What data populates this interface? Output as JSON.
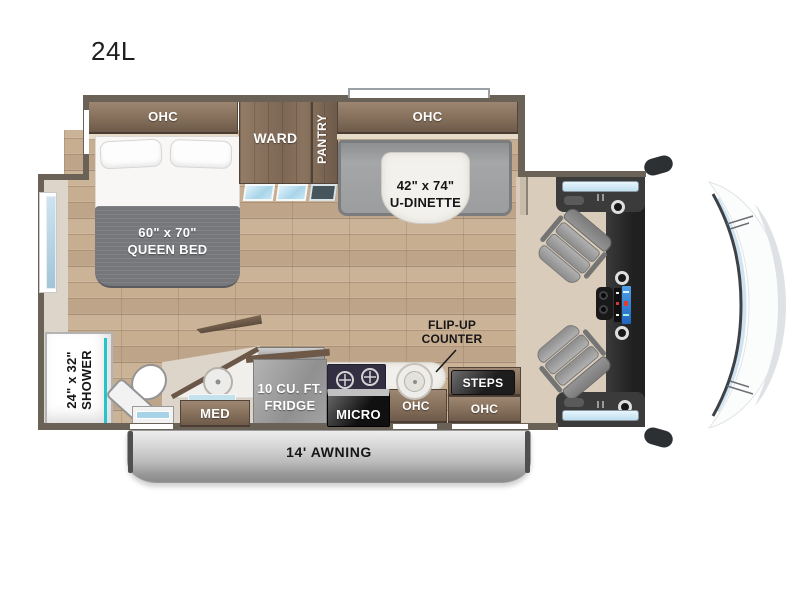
{
  "model": "24L",
  "labels": {
    "ohc_bed": "OHC",
    "ward": "WARD",
    "pantry": "PANTRY",
    "ohc_dinette": "OHC",
    "dinette_size": "42\" x 74\"",
    "dinette_name": "U-DINETTE",
    "bed_size": "60\" x 70\"",
    "bed_name": "QUEEN BED",
    "shower_size": "24\" x 32\"",
    "shower_name": "SHOWER",
    "med": "MED",
    "fridge_size": "10 CU. FT.",
    "fridge_name": "FRIDGE",
    "micro": "MICRO",
    "flipup_line1": "FLIP-UP",
    "flipup_line2": "COUNTER",
    "ohc_kitchen": "OHC",
    "steps": "STEPS",
    "ohc_entry": "OHC",
    "awning": "14' AWNING"
  },
  "colors": {
    "wall": "#6a6157",
    "cabinet_brown": "#7d6753",
    "floor_wood": "#c8ae91",
    "accent_teal": "#23c5cb",
    "mattress_gray": "#75777b",
    "awning_silver": "#bcbcbc"
  }
}
